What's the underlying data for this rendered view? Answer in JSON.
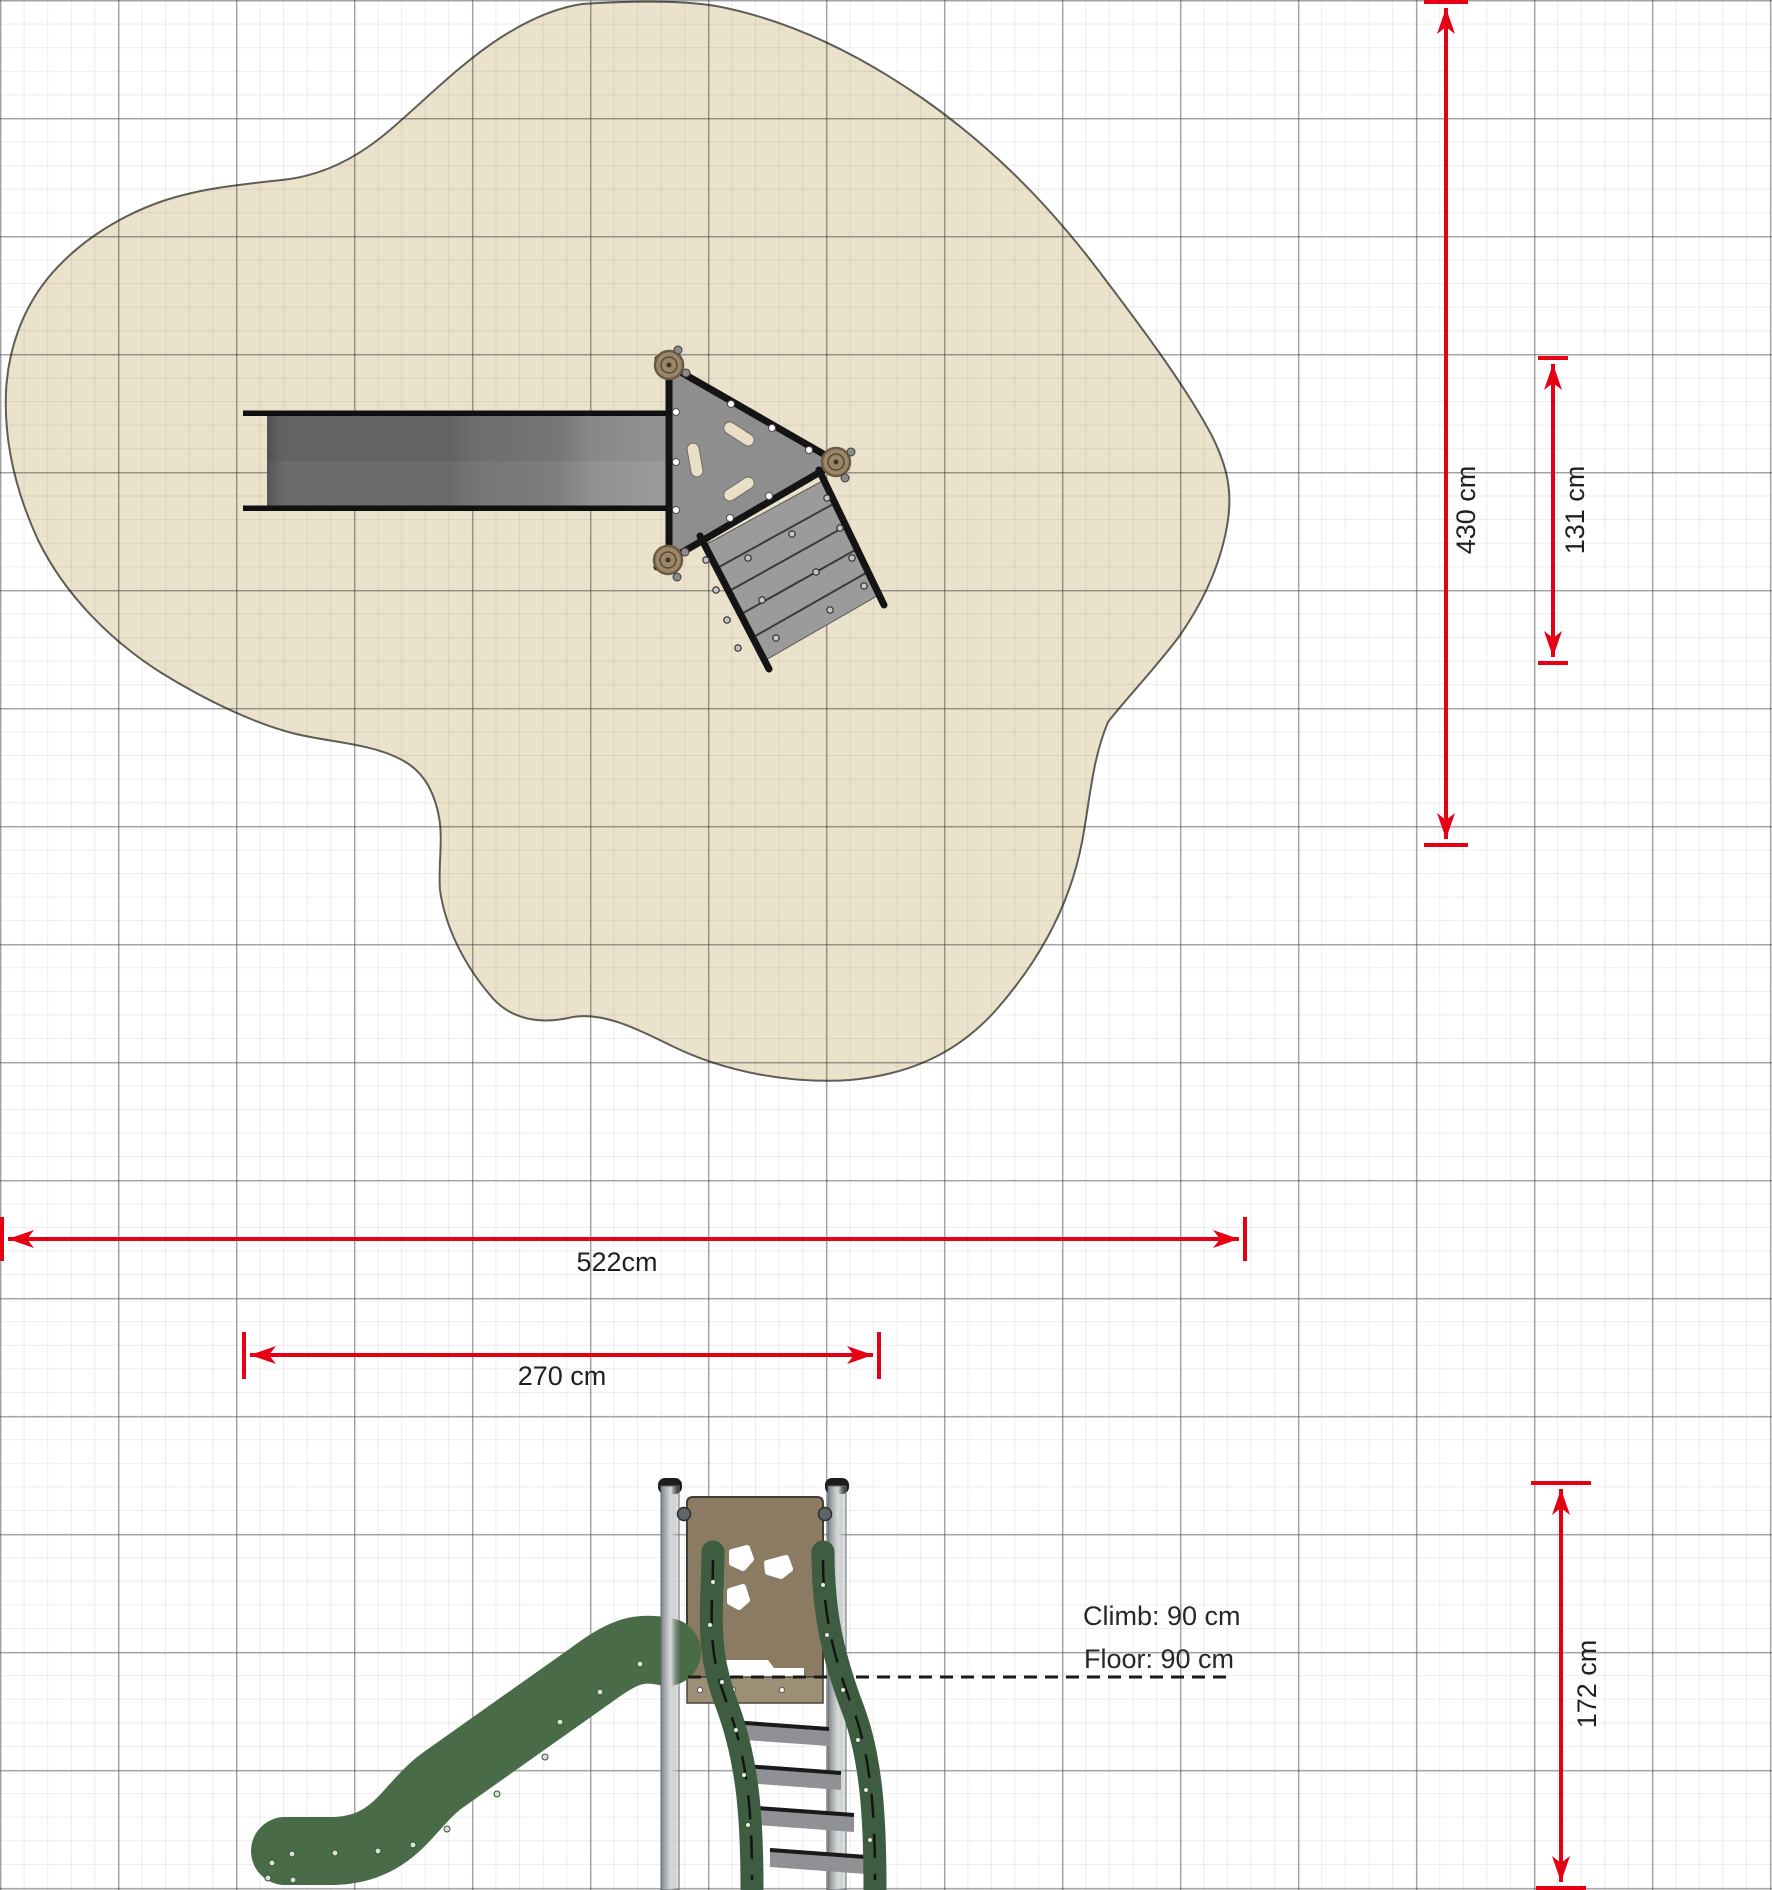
{
  "annotations": {
    "climb": "Climb: 90 cm",
    "floor": "Floor: 90 cm"
  },
  "dimensions": {
    "total_width": "522cm",
    "equipment_width": "270 cm",
    "total_depth": "430 cm",
    "equipment_depth": "131 cm",
    "equipment_height": "172 cm"
  },
  "colors": {
    "dimension_red": "#e60014",
    "safety_surface_sand": "#ebe2cb",
    "sand_outline": "#5f5e56",
    "slide_green": "#4a6b48",
    "rail_green": "#3e5c40",
    "panel_brown": "#8b7b62",
    "panel_strip_brown": "#9d8f75",
    "post_gray": "#b9bec1",
    "deck_gray": "#8e8e8e",
    "step_gray": "#8f9194",
    "outline_black": "#141414"
  },
  "grid": {
    "major_spacing_px": 118,
    "minor_spacing_px": 23.6
  }
}
